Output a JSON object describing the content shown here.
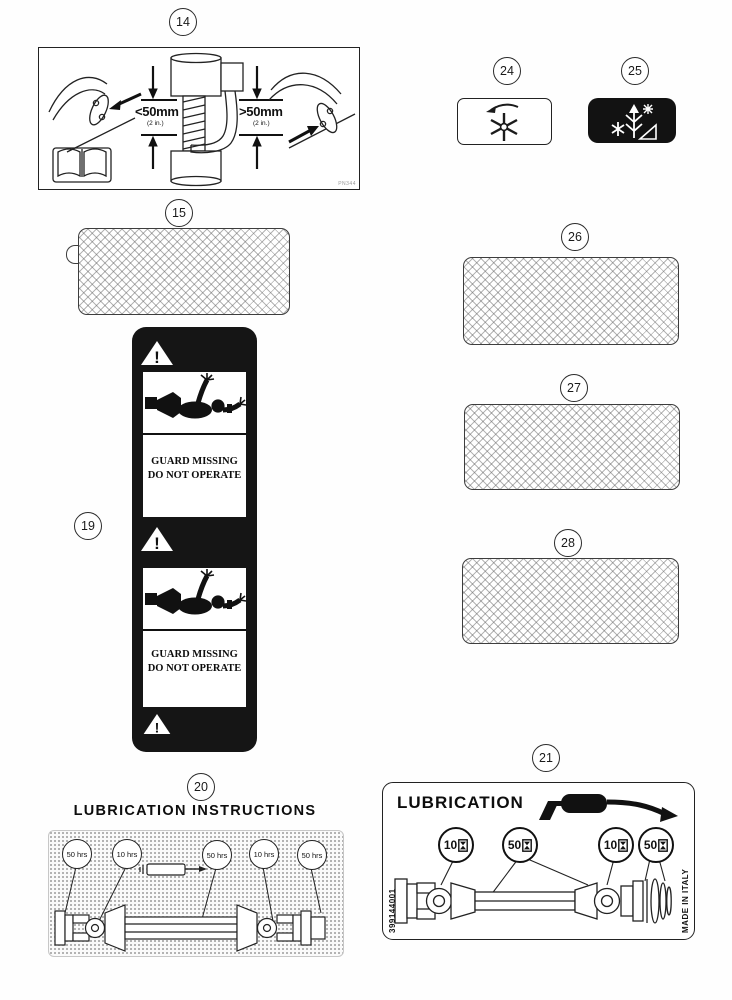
{
  "item14": {
    "number": "14",
    "dim_left": "<50mm",
    "dim_left_unit": "(2 in.)",
    "dim_right": ">50mm",
    "dim_right_unit": "(2 in.)",
    "corner_code": "PN344"
  },
  "item15": {
    "number": "15"
  },
  "item19": {
    "number": "19",
    "warning_mark": "!",
    "line1": "GUARD MISSING",
    "line2": "DO NOT OPERATE"
  },
  "item20": {
    "number": "20",
    "title": "LUBRICATION INSTRUCTIONS",
    "intervals": [
      "50 hrs",
      "10 hrs",
      "50 hrs",
      "10 hrs",
      "50 hrs"
    ]
  },
  "item21": {
    "number": "21",
    "title": "LUBRICATION",
    "intervals": [
      "10",
      "50",
      "10",
      "50"
    ],
    "part_number": "399144001",
    "origin": "MADE IN ITALY"
  },
  "item24": {
    "number": "24"
  },
  "item25": {
    "number": "25"
  },
  "item26": {
    "number": "26"
  },
  "item27": {
    "number": "27"
  },
  "item28": {
    "number": "28"
  },
  "colors": {
    "ink": "#1c1c1c",
    "decal": "#151515"
  }
}
